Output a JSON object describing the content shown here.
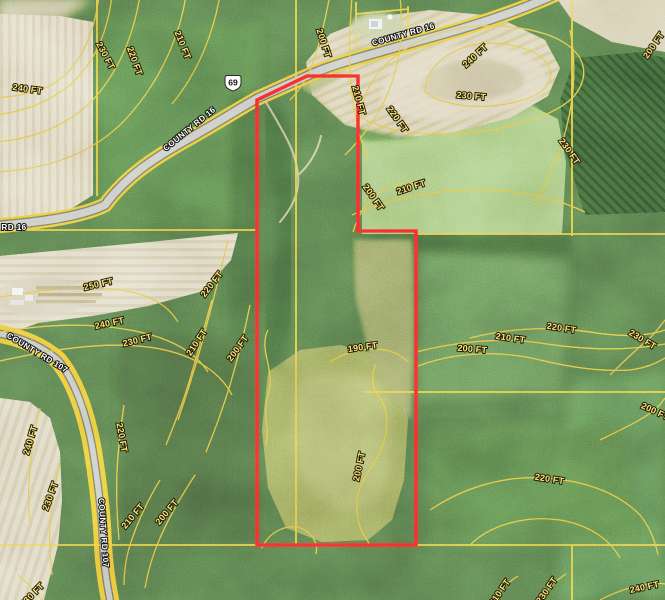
{
  "map": {
    "type": "satellite-topo-parcel-map",
    "boundary_color": "#f21c1c",
    "contour_line_color": "#c8912c",
    "survey_line_color": "#e2a62c",
    "contour_label_color": "#f8e57f",
    "road_label_color": "#ffffff",
    "elevation_unit": "FT",
    "parcel_outline_px": [
      [
        257,
        100
      ],
      [
        307,
        76
      ],
      [
        358,
        76
      ],
      [
        358,
        231
      ],
      [
        416,
        231
      ],
      [
        416,
        545
      ],
      [
        257,
        545
      ]
    ],
    "highway_shield": {
      "label": "69"
    },
    "road_labels": [
      {
        "text": "COUNTY RD 16",
        "x": 191,
        "y": 131,
        "rot": -39
      },
      {
        "text": "COUNTY RD 16",
        "x": 404,
        "y": 37,
        "rot": -16
      },
      {
        "text": "RD 16",
        "x": 14,
        "y": 230,
        "rot": 0
      },
      {
        "text": "COUNTY RD 107",
        "x": 36,
        "y": 355,
        "rot": 31
      },
      {
        "text": "COUNTY RD 107",
        "x": 101,
        "y": 533,
        "rot": 86
      }
    ],
    "contour_labels": [
      {
        "text": "240 FT",
        "x": 27,
        "y": 92,
        "rot": 8
      },
      {
        "text": "230 FT",
        "x": 103,
        "y": 57,
        "rot": 62
      },
      {
        "text": "220 FT",
        "x": 132,
        "y": 62,
        "rot": 70
      },
      {
        "text": "210 FT",
        "x": 180,
        "y": 46,
        "rot": 68
      },
      {
        "text": "200 FT",
        "x": 321,
        "y": 44,
        "rot": 72
      },
      {
        "text": "200 FT",
        "x": 656,
        "y": 47,
        "rot": -55
      },
      {
        "text": "240 FT",
        "x": 477,
        "y": 58,
        "rot": -42
      },
      {
        "text": "230 FT",
        "x": 471,
        "y": 99,
        "rot": 5
      },
      {
        "text": "220 FT",
        "x": 395,
        "y": 121,
        "rot": 55
      },
      {
        "text": "230 FT",
        "x": 567,
        "y": 153,
        "rot": 55
      },
      {
        "text": "210 FT",
        "x": 412,
        "y": 190,
        "rot": -18
      },
      {
        "text": "200 FT",
        "x": 371,
        "y": 199,
        "rot": 55
      },
      {
        "text": "210 FT",
        "x": 356,
        "y": 101,
        "rot": 75
      },
      {
        "text": "250 FT",
        "x": 99,
        "y": 287,
        "rot": -13
      },
      {
        "text": "240 FT",
        "x": 110,
        "y": 326,
        "rot": -12
      },
      {
        "text": "230 FT",
        "x": 138,
        "y": 343,
        "rot": -14
      },
      {
        "text": "220 FT",
        "x": 214,
        "y": 286,
        "rot": -52
      },
      {
        "text": "210 FT",
        "x": 199,
        "y": 344,
        "rot": -56
      },
      {
        "text": "200 FT",
        "x": 240,
        "y": 350,
        "rot": -54
      },
      {
        "text": "190 FT",
        "x": 363,
        "y": 350,
        "rot": -8
      },
      {
        "text": "200 FT",
        "x": 472,
        "y": 352,
        "rot": 5
      },
      {
        "text": "210 FT",
        "x": 510,
        "y": 341,
        "rot": 8
      },
      {
        "text": "220 FT",
        "x": 561,
        "y": 331,
        "rot": 9
      },
      {
        "text": "230 FT",
        "x": 641,
        "y": 342,
        "rot": 31
      },
      {
        "text": "200 FT",
        "x": 654,
        "y": 414,
        "rot": 25
      },
      {
        "text": "240 FT",
        "x": 33,
        "y": 441,
        "rot": -73
      },
      {
        "text": "230 FT",
        "x": 53,
        "y": 497,
        "rot": -70
      },
      {
        "text": "220 FT",
        "x": 119,
        "y": 438,
        "rot": 80
      },
      {
        "text": "210 FT",
        "x": 135,
        "y": 518,
        "rot": -50
      },
      {
        "text": "200 FT",
        "x": 169,
        "y": 514,
        "rot": -50
      },
      {
        "text": "200 FT",
        "x": 362,
        "y": 467,
        "rot": -78
      },
      {
        "text": "220 FT",
        "x": 549,
        "y": 482,
        "rot": 9
      },
      {
        "text": "210 FT",
        "x": 502,
        "y": 594,
        "rot": -55
      },
      {
        "text": "230 FT",
        "x": 549,
        "y": 592,
        "rot": -55
      },
      {
        "text": "240 FT",
        "x": 645,
        "y": 590,
        "rot": -12
      },
      {
        "text": "230 FT",
        "x": 34,
        "y": 597,
        "rot": -45
      }
    ]
  }
}
